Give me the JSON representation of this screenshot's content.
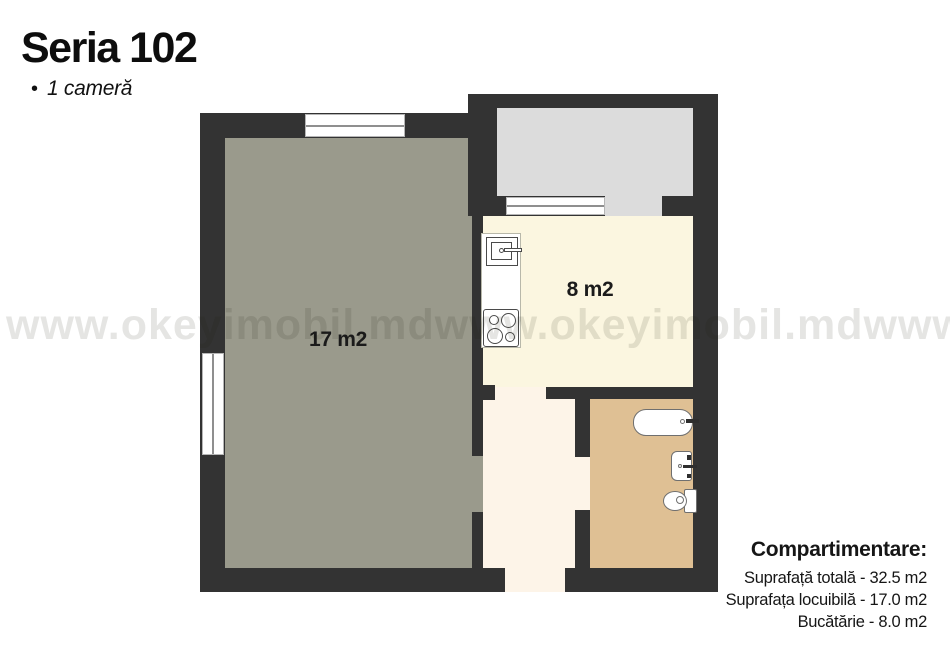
{
  "header": {
    "title": "Seria 102",
    "bullet": "•",
    "subtitle": "1 cameră"
  },
  "watermark": {
    "text": "www.okeyimobil.md"
  },
  "floor_plan": {
    "rooms": {
      "living": {
        "name": "living room",
        "label": "17 m2"
      },
      "kitchen": {
        "name": "kitchen",
        "label": "8 m2"
      },
      "bathroom": {
        "name": "bathroom",
        "label": ""
      },
      "hallway": {
        "name": "hallway",
        "label": ""
      },
      "balcony": {
        "name": "balcony",
        "label": ""
      }
    },
    "colors": {
      "wall": "#333333",
      "living": "#9a9a8c",
      "kitchen": "#fbf6e0",
      "hallway": "#fdf4e8",
      "bathroom": "#dfc094",
      "balcony": "#dcdcdc"
    }
  },
  "legend": {
    "title": "Compartimentare:",
    "lines": [
      "Suprafață totală - 32.5 m2",
      "Suprafața locuibilă - 17.0 m2",
      "Bucătărie - 8.0 m2"
    ]
  }
}
